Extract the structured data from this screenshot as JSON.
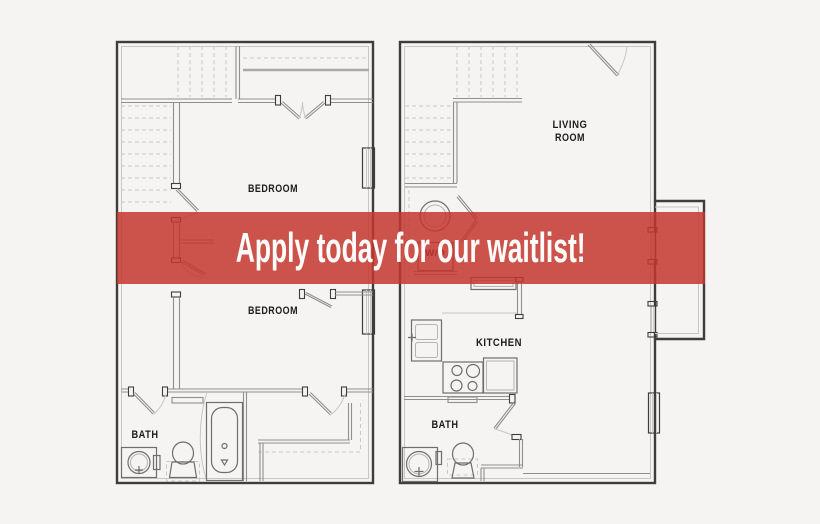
{
  "page": {
    "background_color": "#f5f4f2",
    "plan_wall_color": "#3d3d3d",
    "accent_red": "#c3362e",
    "banner_opacity": "0.85"
  },
  "banner": {
    "label": "Apply today for our waitlist!",
    "text_color": "#ffffff"
  },
  "left_unit": {
    "bedroom_upper_label": "BEDROOM",
    "bedroom_lower_label": "BEDROOM",
    "bath_label": "BATH"
  },
  "right_unit": {
    "living_room_line1": "LIVING",
    "living_room_line2": "ROOM",
    "kitchen_label": "KITCHEN",
    "bath_label": "BATH",
    "washer_dryer_label": "W/D"
  }
}
